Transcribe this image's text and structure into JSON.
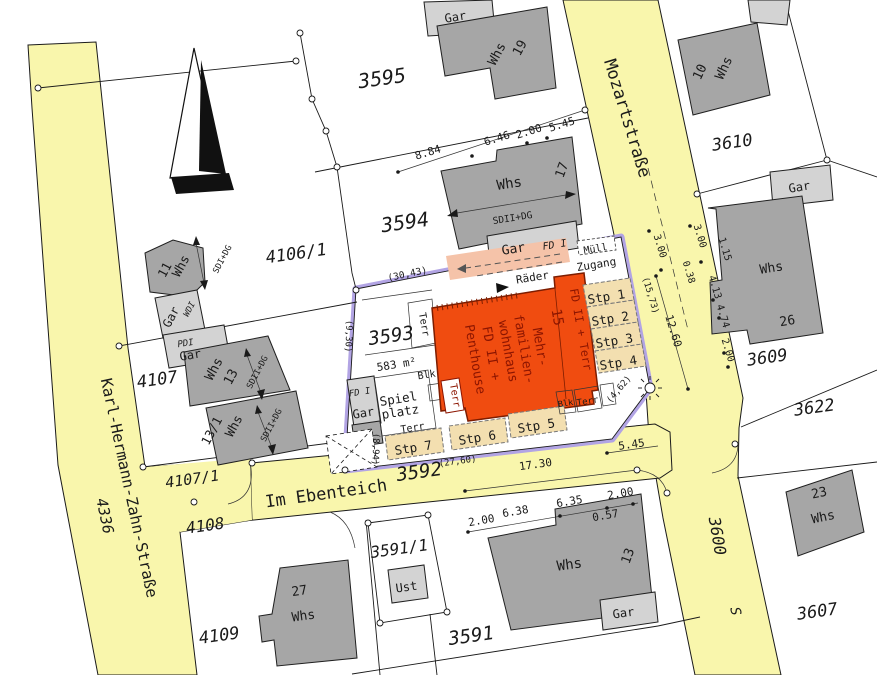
{
  "s": {
    "mozart": "Mozartstraße",
    "khz": "Karl-Hermann-Zahn-Straße",
    "ebenteich": "Im Ebenteich",
    "n3600": "3600",
    "s_label": "S",
    "n4336": "4336",
    "n4108": "4108",
    "n3592": "3592"
  },
  "p": {
    "n3595": "3595",
    "n3594": "3594",
    "n3593": "3593",
    "n3610": "3610",
    "n3609": "3609",
    "n3622": "3622",
    "n3607": "3607",
    "n3591": "3591",
    "n3591_1": "3591/1",
    "n4106_1": "4106/1",
    "n4107": "4107",
    "n4107_1": "4107/1",
    "n4109": "4109"
  },
  "b": {
    "whs": "Whs",
    "gar": "Gar",
    "ust": "Ust",
    "n19": "19",
    "n17": "17",
    "n10": "10",
    "n26": "26",
    "n11": "11",
    "n13": "13",
    "n13_1": "13/1",
    "n27": "27",
    "n23": "23",
    "sd2dg": "SDII+DG",
    "sd1dg": "SDI+DG",
    "wd1": "WDI",
    "pd1": "PDI",
    "fd1": "FD I"
  },
  "c": {
    "fd2": "FD II +",
    "penthouse": "Penthouse",
    "mfh1": "Mehr-",
    "mfh2": "familien-",
    "mfh3": "wohnhaus",
    "n15": "15",
    "fd2terr": "FD II + Terr",
    "raeder": "Räder",
    "muell": "Müll",
    "zugang": "Zugang",
    "spiel": "Spiel",
    "platz": "platz",
    "blk": "Blk",
    "terr": "Terr",
    "area": "583 m²",
    "stp1": "Stp 1",
    "stp2": "Stp 2",
    "stp3": "Stp 3",
    "stp4": "Stp 4",
    "stp5": "Stp 5",
    "stp6": "Stp 6",
    "stp7": "Stp 7"
  },
  "d": {
    "m884": "8.84",
    "m646": "6.46",
    "m200a": "2.00",
    "m545a": "5.45",
    "m300a": "3.00",
    "m300b": "3.00",
    "m038": "0.38",
    "m115": "1.15",
    "m413": "4.13",
    "m474": "4.74",
    "m200b": "2.00",
    "m1260": "12.60",
    "m1573": "(15,73)",
    "m462": "(4,62)",
    "m3043": "(30,43)",
    "m930": "(9,30)",
    "m894": "(8,94)",
    "m2760": "(27,60)",
    "m1730": "17.30",
    "m545b": "5.45",
    "m200c": "2.00",
    "m638": "6.38",
    "m635": "6.35",
    "m200d": "2.00",
    "m057": "0.57"
  },
  "colors": {
    "street": "#f9f6ac",
    "site_boundary": "#b2a4e4",
    "building_dark": "#a6a6a6",
    "building_light": "#d3d3d3",
    "main_building": "#f04c10",
    "parking": "#f3dfb0",
    "bike_area": "#f5c3a9"
  }
}
